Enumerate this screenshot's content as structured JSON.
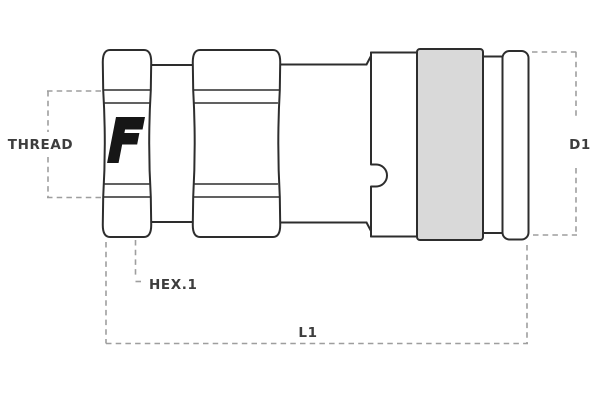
{
  "diagram": {
    "type": "technical-drawing",
    "subject": "hydraulic quick-release coupling, female half, side view",
    "logo_letter": "F",
    "labels": {
      "thread": "THREAD",
      "hex1": "HEX.1",
      "length": "L1",
      "diameter": "D1"
    },
    "colors": {
      "background": "#ffffff",
      "outline": "#2d2d2d",
      "dashed": "#9e9e9e",
      "label_text": "#3d3d3d",
      "sleeve_fill": "#d9d9d9",
      "logo": "#161616"
    }
  }
}
